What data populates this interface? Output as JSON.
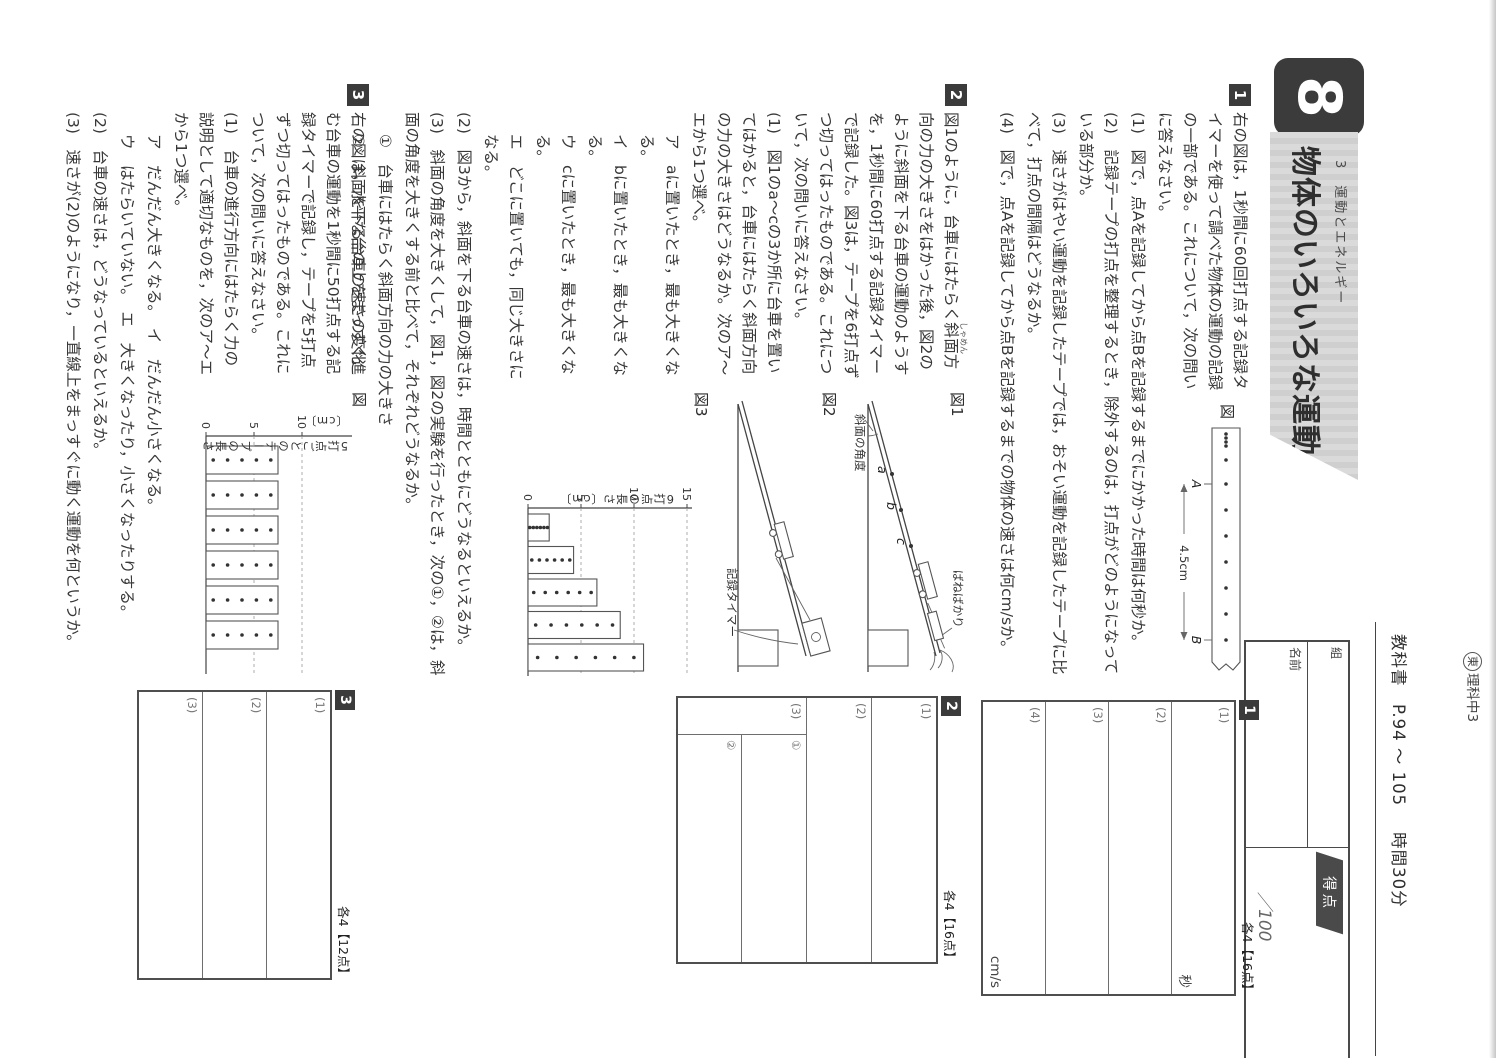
{
  "header": {
    "corner_circle": "東",
    "corner_text": "理科中3",
    "textbook": "教科書　P.94 〜 105",
    "time": "時間30分",
    "unit_number": "8",
    "unit_category": "3　運動とエネルギー",
    "unit_title": "物体のいろいろな運動",
    "class_label": "組",
    "name_label": "名前",
    "score_label": "得点",
    "score_total": "／100"
  },
  "problem1": {
    "number": "1",
    "intro": "右の図は，1秒間に60回打点する記録タイマーを使って調べた物体の運動の記録の一部である。これについて，次の問いに答えなさい。",
    "q1": "(1)　図で，点Aを記録してから点Bを記録するまでにかかった時間は何秒か。",
    "q2": "(2)　記録テープの打点を整理するとき，除外するのは，打点がどのようになっている部分か。",
    "q3": "(3)　速さがはやい運動を記録したテープでは，おそい運動を記録したテープに比べて，打点の間隔はどうなるか。",
    "q4": "(4)　図で，点Aを記録してから点Bを記録するまでの物体の速さは何cm/sか。",
    "figure": {
      "label": "図",
      "point_a": "A",
      "point_b": "B",
      "distance": "4.5cm"
    },
    "answers": {
      "number": "1",
      "note": "各4【16点】",
      "rows": [
        {
          "label": "(1)",
          "unit": "秒"
        },
        {
          "label": "(2)",
          "unit": ""
        },
        {
          "label": "(3)",
          "unit": ""
        },
        {
          "label": "(4)",
          "unit": "cm/s"
        }
      ]
    }
  },
  "problem2": {
    "number": "2",
    "intro_pre": "図1のように，台車にはたらく",
    "ruby_base": "斜面",
    "ruby_text": "しゃめん",
    "intro_post": "方向の力の大きさをはかった後，図2のように斜面を下る台車の運動のようすを，1秒間に60打点する記録タイマーで記録した。図3は，テープを6打点ずつ切ってはったものである。これについて，次の問いに答えなさい。",
    "q1": "(1)　図1のa〜cの3か所に台車を置いてはかると，台車にはたらく斜面方向の力の大きさはどうなるか。次のア〜エから1つ選べ。",
    "choice_a": "ア　aに置いたとき，最も大きくなる。",
    "choice_i": "イ　bに置いたとき，最も大きくなる。",
    "choice_u": "ウ　cに置いたとき，最も大きくなる。",
    "choice_e": "エ　どこに置いても，同じ大きさになる。",
    "q2": "(2)　図3から，斜面を下る台車の速さは，時間とともにどうなるといえるか。",
    "q3": "(3)　斜面の角度を大きくして，図1，図2の実験を行ったとき，次の①，②は，斜面の角度を大きくする前と比べて，それぞれどうなるか。",
    "q3_sub1": "①　台車にはたらく斜面方向の力の大きさ",
    "q3_sub2": "②　斜面を下る台車の速さの変化",
    "fig1": {
      "label": "図1",
      "mark_a": "a",
      "mark_b": "b",
      "mark_c": "c",
      "spring_scale": "ばねばかり",
      "angle": "斜面の角度"
    },
    "fig2": {
      "label": "図2",
      "timer": "記録タイマー"
    },
    "answers": {
      "number": "2",
      "note": "各4【16点】",
      "rows": [
        {
          "label": "(1)"
        },
        {
          "label": "(2)"
        },
        {
          "label": "(3)"
        }
      ],
      "sub_rows": [
        {
          "label": "①"
        },
        {
          "label": "②"
        }
      ]
    }
  },
  "problem3": {
    "number": "3",
    "intro": "右の図は，水平な台の上をまっすぐ進む台車の運動を1秒間に50打点する記録タイマーで記録し，テープを5打点ずつ切ってはったものである。これについて，次の問いに答えなさい。",
    "q1": "(1)　台車の進行方向にはたらく力の説明として適切なものを，次のア〜エから1つ選べ。",
    "choice_line1": "ア　だんだん大きくなる。　イ　だんだん小さくなる。",
    "choice_line2": "ウ　はたらいていない。　エ　大きくなったり，小さくなったりする。",
    "q2": "(2)　台車の速さは，どうなっているといえるか。",
    "q3": "(3)　速さが(2)のようになり，一直線上をまっすぐに動く運動を何というか。",
    "answers": {
      "number": "3",
      "note": "各4【12点】",
      "rows": [
        {
          "label": "(1)"
        },
        {
          "label": "(2)"
        },
        {
          "label": "(3)"
        }
      ]
    }
  },
  "chart_data": [
    {
      "type": "bar",
      "title": "図3",
      "ylabel": "6打点の長さ〔cm〕",
      "yticks": [
        0,
        5,
        10,
        15
      ],
      "ylim": [
        0,
        15
      ],
      "categories": [
        "1",
        "2",
        "3",
        "4",
        "5"
      ],
      "values": [
        2.0,
        4.3,
        6.5,
        8.7,
        10.9
      ],
      "dots_per_strip": 6
    },
    {
      "type": "bar",
      "title": "図",
      "ylabel": "5打点ごとのテープの長さ〔cm〕",
      "yticks": [
        0,
        5,
        10
      ],
      "ylim": [
        0,
        10
      ],
      "categories": [
        "1",
        "2",
        "3",
        "4",
        "5",
        "6"
      ],
      "values": [
        7.5,
        7.5,
        7.5,
        7.5,
        7.5,
        7.5
      ],
      "dots_per_strip": 5
    }
  ]
}
